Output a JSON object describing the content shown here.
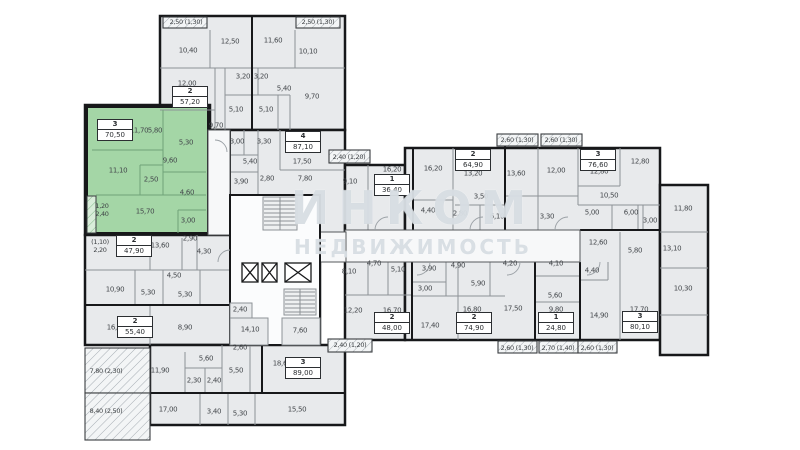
{
  "watermark": {
    "line1": "ИНКОМ",
    "line2": "НЕДВИЖИМОСТЬ"
  },
  "plan": {
    "colors": {
      "highlight": "#a4d6a6",
      "room_fill": "#e8eaec",
      "wall": "#17181a",
      "watermark": "#c1cbd3"
    },
    "apartments": [
      {
        "num": "2",
        "area": "57,20",
        "x": 190,
        "y": 97
      },
      {
        "num": "3",
        "area": "70,50",
        "x": 115,
        "y": 130,
        "hl": true
      },
      {
        "num": "4",
        "area": "87,10",
        "x": 303,
        "y": 142
      },
      {
        "num": "2",
        "area": "47,90",
        "x": 134,
        "y": 246
      },
      {
        "num": "2",
        "area": "55,40",
        "x": 135,
        "y": 327
      },
      {
        "num": "3",
        "area": "89,00",
        "x": 303,
        "y": 368
      },
      {
        "num": "1",
        "area": "36,40",
        "x": 392,
        "y": 185
      },
      {
        "num": "2",
        "area": "64,90",
        "x": 473,
        "y": 160
      },
      {
        "num": "3",
        "area": "76,60",
        "x": 598,
        "y": 160
      },
      {
        "num": "2",
        "area": "48,00",
        "x": 392,
        "y": 323
      },
      {
        "num": "2",
        "area": "74,90",
        "x": 474,
        "y": 323
      },
      {
        "num": "1",
        "area": "24,80",
        "x": 556,
        "y": 323
      },
      {
        "num": "3",
        "area": "80,10",
        "x": 640,
        "y": 322
      }
    ],
    "room_labels": [
      {
        "t": "10,40",
        "x": 188,
        "y": 51
      },
      {
        "t": "12,50",
        "x": 230,
        "y": 42
      },
      {
        "t": "11,60",
        "x": 273,
        "y": 41
      },
      {
        "t": "10,10",
        "x": 308,
        "y": 52
      },
      {
        "t": "12,00",
        "x": 187,
        "y": 84
      },
      {
        "t": "3,20",
        "x": 243,
        "y": 77
      },
      {
        "t": "3,20",
        "x": 261,
        "y": 77
      },
      {
        "t": "5,40",
        "x": 284,
        "y": 89
      },
      {
        "t": "9,70",
        "x": 312,
        "y": 97
      },
      {
        "t": "5,10",
        "x": 236,
        "y": 110
      },
      {
        "t": "5,10",
        "x": 266,
        "y": 110
      },
      {
        "t": "9,70",
        "x": 216,
        "y": 126
      },
      {
        "t": "11,70",
        "x": 139,
        "y": 131
      },
      {
        "t": "5,80",
        "x": 155,
        "y": 131
      },
      {
        "t": "5,30",
        "x": 186,
        "y": 143
      },
      {
        "t": "9,60",
        "x": 170,
        "y": 161
      },
      {
        "t": "11,10",
        "x": 118,
        "y": 171
      },
      {
        "t": "2,50",
        "x": 151,
        "y": 180
      },
      {
        "t": "4,60",
        "x": 187,
        "y": 193
      },
      {
        "t": "15,70",
        "x": 145,
        "y": 212
      },
      {
        "t": "3,00",
        "x": 188,
        "y": 221
      },
      {
        "t": "3,00",
        "x": 237,
        "y": 142
      },
      {
        "t": "3,30",
        "x": 264,
        "y": 142
      },
      {
        "t": "5,40",
        "x": 250,
        "y": 162
      },
      {
        "t": "17,50",
        "x": 302,
        "y": 162
      },
      {
        "t": "3,90",
        "x": 241,
        "y": 182
      },
      {
        "t": "2,80",
        "x": 267,
        "y": 179
      },
      {
        "t": "7,80",
        "x": 305,
        "y": 179
      },
      {
        "t": "9,10",
        "x": 350,
        "y": 182
      },
      {
        "t": "13,60",
        "x": 160,
        "y": 246
      },
      {
        "t": "2,90",
        "x": 190,
        "y": 239
      },
      {
        "t": "4,30",
        "x": 204,
        "y": 252
      },
      {
        "t": "4,50",
        "x": 174,
        "y": 276
      },
      {
        "t": "10,90",
        "x": 115,
        "y": 290
      },
      {
        "t": "5,30",
        "x": 148,
        "y": 293
      },
      {
        "t": "5,30",
        "x": 185,
        "y": 295
      },
      {
        "t": "16,50",
        "x": 116,
        "y": 328
      },
      {
        "t": "8,90",
        "x": 185,
        "y": 328
      },
      {
        "t": "2,40",
        "x": 240,
        "y": 310
      },
      {
        "t": "14,10",
        "x": 250,
        "y": 330
      },
      {
        "t": "7,60",
        "x": 300,
        "y": 331
      },
      {
        "t": "2,60",
        "x": 240,
        "y": 348
      },
      {
        "t": "11,90",
        "x": 160,
        "y": 371
      },
      {
        "t": "5,60",
        "x": 206,
        "y": 359
      },
      {
        "t": "5,50",
        "x": 236,
        "y": 371
      },
      {
        "t": "2,30",
        "x": 194,
        "y": 381
      },
      {
        "t": "2,40",
        "x": 214,
        "y": 381
      },
      {
        "t": "17,00",
        "x": 168,
        "y": 410
      },
      {
        "t": "3,40",
        "x": 214,
        "y": 412
      },
      {
        "t": "5,30",
        "x": 240,
        "y": 414
      },
      {
        "t": "15,50",
        "x": 297,
        "y": 410
      },
      {
        "t": "18,60",
        "x": 282,
        "y": 364
      },
      {
        "t": "16,20",
        "x": 392,
        "y": 170
      },
      {
        "t": "16,20",
        "x": 433,
        "y": 169
      },
      {
        "t": "13,20",
        "x": 473,
        "y": 174
      },
      {
        "t": "3,50",
        "x": 481,
        "y": 197
      },
      {
        "t": "4,40",
        "x": 428,
        "y": 211
      },
      {
        "t": "2,80",
        "x": 460,
        "y": 214
      },
      {
        "t": "6,10",
        "x": 497,
        "y": 217
      },
      {
        "t": "3,30",
        "x": 547,
        "y": 217
      },
      {
        "t": "13,60",
        "x": 516,
        "y": 174
      },
      {
        "t": "12,00",
        "x": 556,
        "y": 171
      },
      {
        "t": "12,80",
        "x": 599,
        "y": 172
      },
      {
        "t": "12,80",
        "x": 640,
        "y": 162
      },
      {
        "t": "10,50",
        "x": 609,
        "y": 196
      },
      {
        "t": "5,00",
        "x": 592,
        "y": 213
      },
      {
        "t": "6,00",
        "x": 631,
        "y": 213
      },
      {
        "t": "3,00",
        "x": 650,
        "y": 221
      },
      {
        "t": "11,80",
        "x": 683,
        "y": 209
      },
      {
        "t": "13,10",
        "x": 672,
        "y": 249
      },
      {
        "t": "12,60",
        "x": 598,
        "y": 243
      },
      {
        "t": "5,80",
        "x": 635,
        "y": 251
      },
      {
        "t": "4,40",
        "x": 592,
        "y": 271
      },
      {
        "t": "10,30",
        "x": 683,
        "y": 289
      },
      {
        "t": "14,90",
        "x": 599,
        "y": 316
      },
      {
        "t": "17,70",
        "x": 639,
        "y": 310
      },
      {
        "t": "8,10",
        "x": 349,
        "y": 272
      },
      {
        "t": "4,70",
        "x": 374,
        "y": 264
      },
      {
        "t": "5,10",
        "x": 398,
        "y": 270
      },
      {
        "t": "12,20",
        "x": 353,
        "y": 311
      },
      {
        "t": "16,70",
        "x": 392,
        "y": 311
      },
      {
        "t": "17,40",
        "x": 430,
        "y": 326
      },
      {
        "t": "16,80",
        "x": 472,
        "y": 310
      },
      {
        "t": "17,50",
        "x": 513,
        "y": 309
      },
      {
        "t": "3,90",
        "x": 429,
        "y": 269
      },
      {
        "t": "3,00",
        "x": 425,
        "y": 289
      },
      {
        "t": "4,90",
        "x": 458,
        "y": 266
      },
      {
        "t": "5,90",
        "x": 478,
        "y": 284
      },
      {
        "t": "4,20",
        "x": 510,
        "y": 264
      },
      {
        "t": "4,10",
        "x": 556,
        "y": 264
      },
      {
        "t": "5,60",
        "x": 555,
        "y": 296
      },
      {
        "t": "9,80",
        "x": 556,
        "y": 310
      }
    ],
    "balcony_labels": [
      {
        "t": "2,50 (1,30)",
        "x": 186,
        "y": 22
      },
      {
        "t": "2,50 (1,30)",
        "x": 318,
        "y": 22
      },
      {
        "t": "2,40 (1,20)",
        "x": 349,
        "y": 157
      },
      {
        "t": "2,60 (1,30)",
        "x": 517,
        "y": 140
      },
      {
        "t": "2,60 (1,30)",
        "x": 561,
        "y": 140
      },
      {
        "t": "2,40 (1,20)",
        "x": 350,
        "y": 345
      },
      {
        "t": "2,60 (1,30)",
        "x": 517,
        "y": 348
      },
      {
        "t": "2,70 (1,40)",
        "x": 558,
        "y": 348
      },
      {
        "t": "2,60 (1,30)",
        "x": 597,
        "y": 348
      },
      {
        "t": "7,80 (2,30)",
        "x": 106,
        "y": 371
      },
      {
        "t": "8,40 (2,50)",
        "x": 106,
        "y": 411
      }
    ],
    "stacked_labels": [
      {
        "lines": [
          "1,20",
          "2,40"
        ],
        "x": 102,
        "y": 211
      },
      {
        "lines": [
          "(1,10)",
          "2,20"
        ],
        "x": 100,
        "y": 247
      }
    ]
  }
}
